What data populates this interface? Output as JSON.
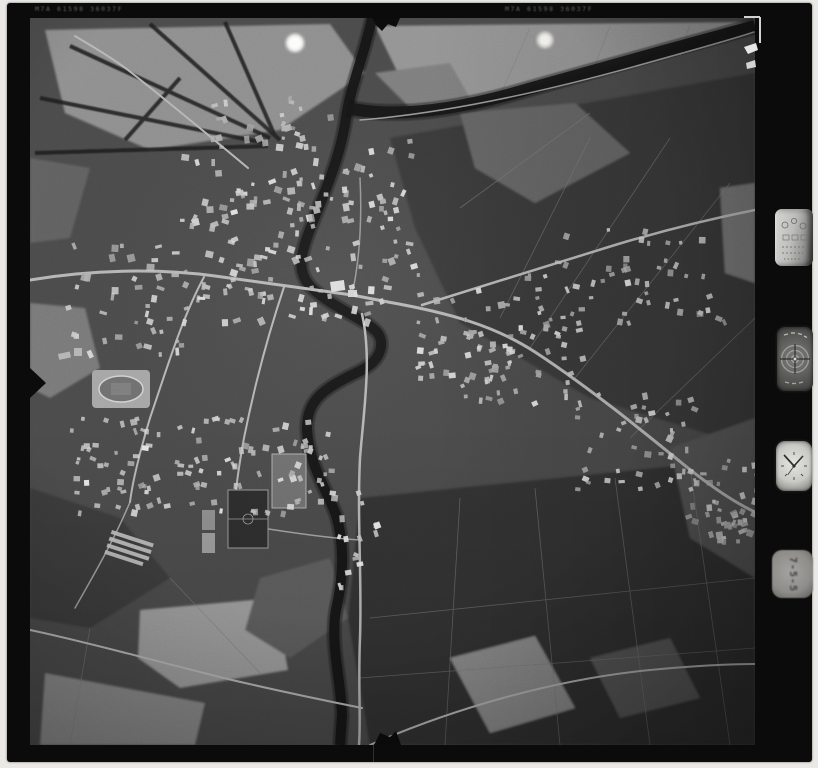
{
  "film": {
    "edge_code_left": "M7A 61598 36037F",
    "edge_code_right": "M7A 61598 36037F",
    "frame_counter": "7-5-5",
    "media_type": "black-and-white aerial survey film frame"
  },
  "instruments": {
    "data_panel": "exposure data panel",
    "level_dial": "bubble level dial",
    "clock": "mission clock",
    "clock_hands_time": "10:08",
    "frame_counter_label": "frame counter"
  },
  "scene": {
    "description": "Vertical aerial photograph of a small town: dark sinuous river flowing north-south with a tree-lined branch curving to the northeast corner, dense town core west of the river, ribbon development along a road running southeast, grid of houses to the southwest, stadium with oval track, sports pitches, greenhouses, and a patchwork of light and dark farm fields.",
    "palette": {
      "field_base": "#474747",
      "field_dark": "#363636",
      "field_light": "#949494",
      "water": "#141414",
      "road": "#b6b6b6",
      "building": "#c8c8c8"
    },
    "building_clusters": [
      {
        "id": "town-core",
        "x": 150,
        "y": 118,
        "w": 235,
        "h": 185,
        "count": 165,
        "min_size": 3,
        "size_var": 5,
        "tone": 170,
        "seed": 11
      },
      {
        "id": "east-bank",
        "x": 385,
        "y": 255,
        "w": 130,
        "h": 105,
        "count": 55,
        "min_size": 3,
        "size_var": 4,
        "tone": 165,
        "seed": 22
      },
      {
        "id": "ne-village",
        "x": 525,
        "y": 210,
        "w": 170,
        "h": 95,
        "count": 48,
        "min_size": 3,
        "size_var": 4,
        "tone": 165,
        "seed": 33
      },
      {
        "id": "ribbon-southeast-1",
        "x": 430,
        "y": 300,
        "w": 120,
        "h": 85,
        "count": 40,
        "min_size": 3,
        "size_var": 4,
        "tone": 168,
        "seed": 44
      },
      {
        "id": "ribbon-southeast-2",
        "x": 545,
        "y": 375,
        "w": 125,
        "h": 95,
        "count": 42,
        "min_size": 3,
        "size_var": 4,
        "tone": 168,
        "seed": 55
      },
      {
        "id": "ribbon-southeast-3",
        "x": 655,
        "y": 440,
        "w": 70,
        "h": 85,
        "count": 30,
        "min_size": 3,
        "size_var": 4,
        "tone": 168,
        "seed": 66
      },
      {
        "id": "southwest-grid",
        "x": 40,
        "y": 398,
        "w": 265,
        "h": 95,
        "count": 115,
        "min_size": 3,
        "size_var": 4,
        "tone": 172,
        "seed": 77
      },
      {
        "id": "west-edge",
        "x": 35,
        "y": 225,
        "w": 115,
        "h": 110,
        "count": 40,
        "min_size": 3,
        "size_var": 5,
        "tone": 165,
        "seed": 88
      },
      {
        "id": "river-strip-south",
        "x": 300,
        "y": 470,
        "w": 45,
        "h": 110,
        "count": 16,
        "min_size": 3,
        "size_var": 4,
        "tone": 180,
        "seed": 99
      },
      {
        "id": "right-edge-exit",
        "x": 685,
        "y": 465,
        "w": 40,
        "h": 60,
        "count": 14,
        "min_size": 3,
        "size_var": 4,
        "tone": 170,
        "seed": 101
      },
      {
        "id": "north-scatter",
        "x": 180,
        "y": 75,
        "w": 120,
        "h": 50,
        "count": 18,
        "min_size": 3,
        "size_var": 4,
        "tone": 160,
        "seed": 113
      }
    ]
  }
}
